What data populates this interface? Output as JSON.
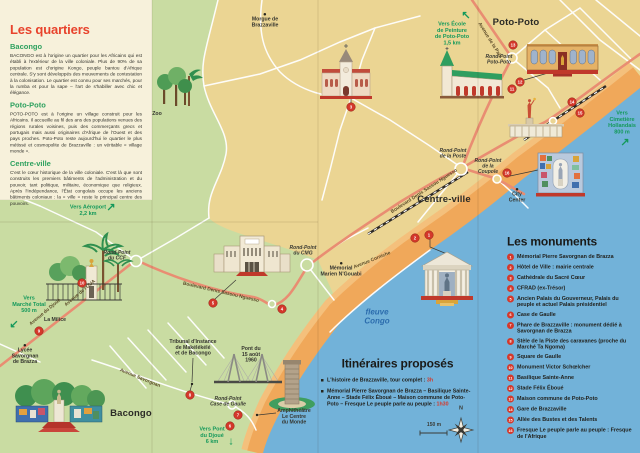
{
  "quartiers": {
    "title": "Les quartiers",
    "sections": [
      {
        "name": "Bacongo",
        "text": "BACONGO est à l'origine un quartier pour les Africains qui est établi à l'extérieur de la ville coloniale. Plus de 90% de sa population est d'origine Kongo, peuple bantou d'Afrique centrale. S'y sont développés des mouvements de contestation à la colonisation. Le quartier est connu pour ses marchés, pour la rumba et pour la sape – l'art de s'habiller avec chic et élégance."
      },
      {
        "name": "Poto-Poto",
        "text": "POTO-POTO est à l'origine un village construit pour les Africains. Il accueille au fil des ans des populations venues des régions rurales voisines, puis des commerçants grecs et portugais mais aussi originaires d'Afrique de l'Ouest et des pays proches. Poto-Poto reste aujourd'hui le quartier le plus métissé et cosmopolite de Brazzaville : un véritable « village monde »."
      },
      {
        "name": "Centre-ville",
        "text": "C'est le cœur historique de la ville coloniale. C'est là que sont construits les premiers bâtiments de l'administration et du pouvoir, tant politique, militaire, économique que religieux. Après l'Indépendance, l'État congolais occupe les anciens bâtiments coloniaux : la « ville » reste le principal centre des pouvoirs."
      }
    ]
  },
  "monuments": {
    "title": "Les monuments",
    "items": [
      {
        "num": "1",
        "label": "Mémorial Pierre Savorgnan de Brazza"
      },
      {
        "num": "2",
        "label": "Hôtel de Ville : mairie centrale"
      },
      {
        "num": "3",
        "label": "Cathédrale du Sacré Cœur"
      },
      {
        "num": "4",
        "label": "CFRAD (ex-Trésor)"
      },
      {
        "num": "5",
        "label": "Ancien Palais du Gouverneur, Palais du peuple et actuel Palais présidentiel"
      },
      {
        "num": "6",
        "label": "Case de Gaulle"
      },
      {
        "num": "7",
        "label": "Phare de Brazzaville : monument dédié à Savorgnan de Brazza"
      },
      {
        "num": "8",
        "label": "Stèle de la Piste des caravanes (proche du Marché Ta Ngoma)"
      },
      {
        "num": "9",
        "label": "Square de Gaulle"
      },
      {
        "num": "10",
        "label": "Monument Victor Schœlcher"
      },
      {
        "num": "11",
        "label": "Basilique Sainte-Anne"
      },
      {
        "num": "12",
        "label": "Stade Félix Éboué"
      },
      {
        "num": "13",
        "label": "Maison commune de Poto-Poto"
      },
      {
        "num": "14",
        "label": "Gare de Brazzaville"
      },
      {
        "num": "15",
        "label": "Allée des Bustes et des Talents"
      },
      {
        "num": "16",
        "label": "Fresque Le peuple parle au peuple : Fresque de l'Afrique"
      }
    ]
  },
  "itineraries": {
    "title": "Itinéraires proposés",
    "items": [
      {
        "text": "L'histoire de Brazzaville, tour complet : ",
        "duration": "3h"
      },
      {
        "text": "Mémorial Pierre Savorgnan de Brazza – Basilique Sainte-Anne – Stade Félix Éboué – Maison commune de Poto-Poto – Fresque Le peuple parle au peuple : ",
        "duration": "1h30"
      }
    ]
  },
  "map": {
    "labels": [
      {
        "cls": "district",
        "text": "Poto-Poto",
        "x": 516,
        "y": 17
      },
      {
        "cls": "district",
        "text": "Centre-ville",
        "x": 444,
        "y": 194
      },
      {
        "cls": "district",
        "text": "Bacongo",
        "x": 131,
        "y": 408
      },
      {
        "cls": "place",
        "dot": true,
        "text": "Morgue de\nBrazzaville",
        "x": 265,
        "y": 13
      },
      {
        "cls": "place",
        "text": "Zoo",
        "x": 157,
        "y": 111
      },
      {
        "cls": "place",
        "dot": true,
        "text": "City\nCenter",
        "x": 517,
        "y": 188
      },
      {
        "cls": "place",
        "dot": true,
        "text": "Mémorial\nMarien N'Gouabi",
        "x": 341,
        "y": 262
      },
      {
        "cls": "place",
        "text": "La Milice",
        "x": 55,
        "y": 317
      },
      {
        "cls": "place",
        "dot": true,
        "text": "Lycée\nSavorgnan\nde Brazza",
        "x": 25,
        "y": 344
      },
      {
        "cls": "place",
        "text": "Tribunal d'Instance\nde Makélékélé\net de Bacongo",
        "x": 193,
        "y": 339
      },
      {
        "cls": "place",
        "text": "Pont du\n15 août\n1960",
        "x": 251,
        "y": 346
      },
      {
        "cls": "place",
        "text": "Amphithéâtre\nLe Centre\ndu Monde",
        "x": 294,
        "y": 408
      },
      {
        "cls": "round",
        "text": "Rond-Point\nPoto-Poto",
        "x": 499,
        "y": 54
      },
      {
        "cls": "round",
        "text": "Rond-Point\nde la Poste",
        "x": 453,
        "y": 148
      },
      {
        "cls": "round",
        "text": "Rond-Point\nde la\nCoupole",
        "x": 488,
        "y": 158
      },
      {
        "cls": "round",
        "text": "Rond-Point\ndu CMG",
        "x": 303,
        "y": 245
      },
      {
        "cls": "round",
        "text": "Rond-Point\ndu CCF",
        "x": 117,
        "y": 250
      },
      {
        "cls": "round",
        "text": "Rond-Point\nCase de Gaulle",
        "x": 228,
        "y": 396
      },
      {
        "cls": "road",
        "text": "Avenue de la Paix",
        "x": 490,
        "y": 40,
        "rot": 58
      },
      {
        "cls": "road",
        "text": "Avenue Corniche",
        "x": 372,
        "y": 260,
        "rot": -22
      },
      {
        "cls": "road",
        "text": "Boulevard Denis Sassou Nguesso",
        "x": 221,
        "y": 292,
        "rot": 13
      },
      {
        "cls": "road",
        "text": "Boulevard Denis Sassou Nguesso",
        "x": 424,
        "y": 191,
        "rot": -33
      },
      {
        "cls": "road",
        "text": "Avenue de l'OUA",
        "x": 80,
        "y": 293,
        "rot": -40
      },
      {
        "cls": "road",
        "text": "Avenue du Djoué",
        "x": 45,
        "y": 312,
        "rot": -40
      },
      {
        "cls": "road",
        "text": "Avenue Savorgnan",
        "x": 140,
        "y": 378,
        "rot": 22
      },
      {
        "cls": "dir",
        "text": "Vers École\nde Peinture\nde Poto-Poto\n1,5 km",
        "x": 452,
        "y": 21
      },
      {
        "cls": "dir",
        "text": "Vers\nCimetière\nHollandais\n800 m",
        "x": 622,
        "y": 110
      },
      {
        "cls": "dir",
        "text": "Vers Aéroport\n2,2 km",
        "x": 88,
        "y": 204
      },
      {
        "cls": "dir",
        "text": "Vers\nMarché Total\n500 m",
        "x": 29,
        "y": 295
      },
      {
        "cls": "dir",
        "text": "Vers Pont\ndu Djoué\n6 km",
        "x": 212,
        "y": 426
      },
      {
        "cls": "river",
        "text": "fleuve\nCongo",
        "x": 377,
        "y": 308
      },
      {
        "cls": "compassN",
        "text": "N",
        "x": 461,
        "y": 405
      },
      {
        "cls": "scaleLbl",
        "text": "150 m",
        "x": 434,
        "y": 422
      }
    ],
    "arrows": [
      {
        "g": "↖",
        "x": 466,
        "y": 15
      },
      {
        "g": "↗",
        "x": 625,
        "y": 142
      },
      {
        "g": "↗",
        "x": 111,
        "y": 207
      },
      {
        "g": "↙",
        "x": 14,
        "y": 324
      },
      {
        "g": "↓",
        "x": 231,
        "y": 441
      }
    ],
    "markers": [
      {
        "n": "1",
        "x": 429,
        "y": 235
      },
      {
        "n": "2",
        "x": 415,
        "y": 238
      },
      {
        "n": "3",
        "x": 351,
        "y": 107
      },
      {
        "n": "4",
        "x": 282,
        "y": 309
      },
      {
        "n": "5",
        "x": 213,
        "y": 303
      },
      {
        "n": "6",
        "x": 230,
        "y": 426
      },
      {
        "n": "7",
        "x": 238,
        "y": 415
      },
      {
        "n": "8",
        "x": 190,
        "y": 395
      },
      {
        "n": "9",
        "x": 39,
        "y": 331
      },
      {
        "n": "10",
        "x": 82,
        "y": 283
      },
      {
        "n": "11",
        "x": 512,
        "y": 89
      },
      {
        "n": "12",
        "x": 520,
        "y": 82
      },
      {
        "n": "13",
        "x": 513,
        "y": 45
      },
      {
        "n": "14",
        "x": 572,
        "y": 102
      },
      {
        "n": "15",
        "x": 580,
        "y": 113
      },
      {
        "n": "16",
        "x": 507,
        "y": 173
      }
    ]
  },
  "colors": {
    "accent_red": "#D4382B",
    "title_red": "#E8432C",
    "quartier_green": "#2EA15F",
    "direction_green": "#14995B",
    "road_salmon": "#E98D72",
    "river_blue": "#72B2D9",
    "land_green": "#C9DCA2",
    "land_yellow": "#EBD593",
    "beach_orange": "#F0A85A",
    "panel_cream": "#F7F1DB"
  }
}
